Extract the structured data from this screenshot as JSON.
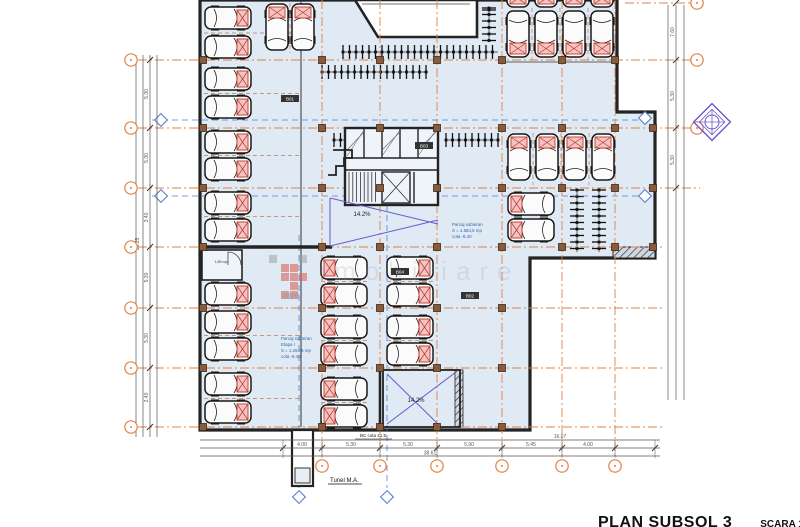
{
  "title_block": {
    "title": "PLAN SUBSOL 3",
    "scale": "SCARA 1:100"
  },
  "plan": {
    "ramp_label_mid": "14.2%",
    "ramp_label_bottom": "14.2%",
    "tunnel_label": "Tunel M.A.",
    "note_label": "BC cota 41.5",
    "small_room_label": "1,65 mp",
    "room_labels": [
      {
        "lines": [
          "Parcaj subteran",
          "S = 1.584,5 mp",
          "cota -8.40"
        ]
      },
      {
        "lines": [
          "Parcaj subteran",
          "Etapa I",
          "S = 1.264,5 mp",
          "cota -8.40"
        ]
      }
    ],
    "room_tags": [
      "B01",
      "B02",
      "B03",
      "B04"
    ],
    "watermark_text": "imobiliare"
  },
  "dimensions": {
    "bottom": {
      "segments": [
        "4.00",
        "5.30",
        "5.30",
        "5.90",
        "5.45",
        "4.00"
      ],
      "subtotal": "16.07",
      "total": "38.61"
    },
    "left": {
      "segments": [
        "5.30",
        "5.30",
        "3.40",
        "5.30",
        "5.30",
        "2.40"
      ],
      "total": "30.25"
    },
    "right": {
      "segments": [
        "7.60",
        "5.30",
        "5.30"
      ]
    }
  },
  "colors": {
    "plan_fill": "#dfeaf4",
    "wall": "#232323",
    "grid_orange": "#e08040",
    "grid_blue": "#5580d0",
    "column_brown": "#8a5a3a",
    "car_pad_fill": "#f2c4c4",
    "car_pad_stroke": "#c0392b",
    "ramp_purple": "#6a5acd",
    "dim_gray": "#555555",
    "label_blue": "#3366aa",
    "logo_red": "#d96459",
    "logo_gray": "#9aa0a6"
  }
}
